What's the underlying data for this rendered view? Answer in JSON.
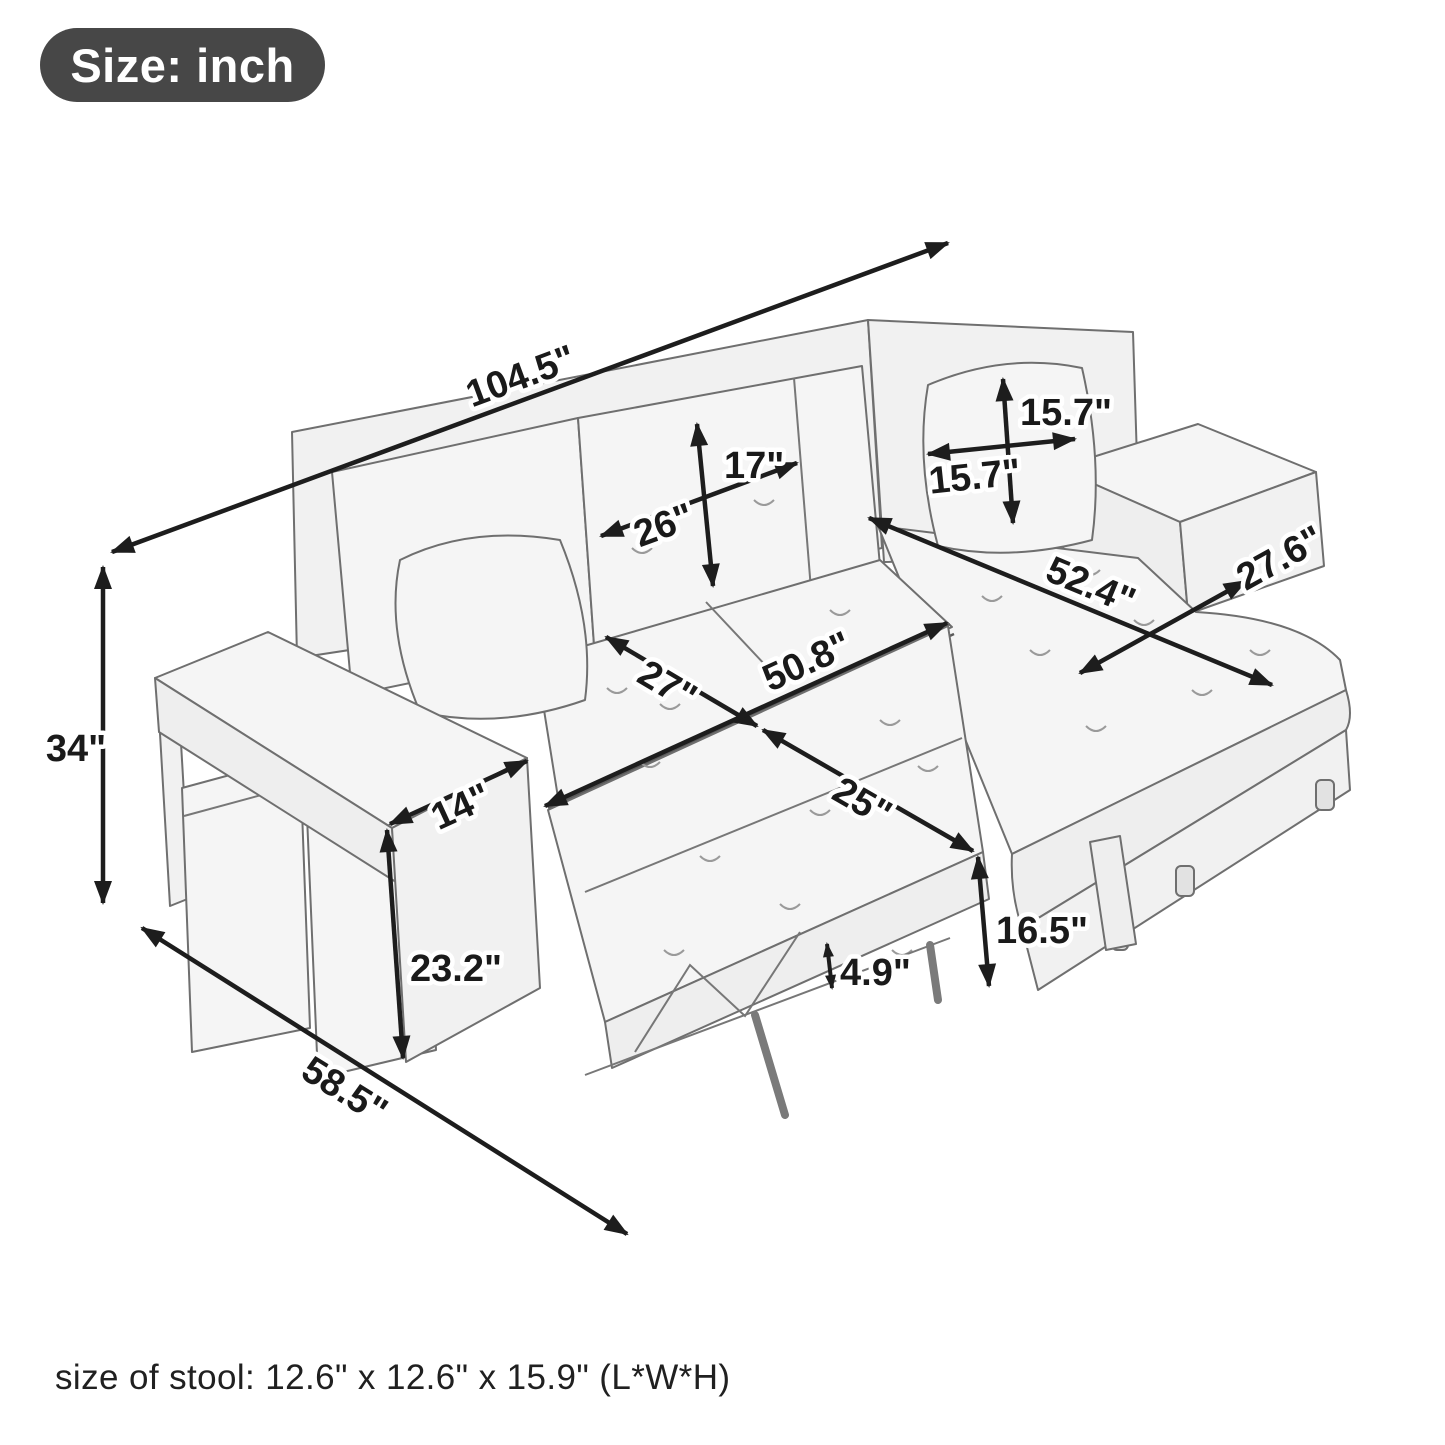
{
  "badge": {
    "label": "Size: inch"
  },
  "footer": {
    "stool_note": "size of stool: 12.6\" x 12.6\" x 15.9\" (L*W*H)"
  },
  "dims": {
    "overall_length": "104.5\"",
    "overall_height": "34\"",
    "overall_depth": "58.5\"",
    "back_cushion_height": "17\"",
    "back_cushion_width": "26\"",
    "pillow_height": "15.7\"",
    "pillow_width": "15.7\"",
    "chaise_length": "52.4\"",
    "chaise_width": "27.6\"",
    "seat_depth": "27\"",
    "bed_length": "50.8\"",
    "bed_depth": "25\"",
    "bed_height": "16.5\"",
    "mattress_thickness": "4.9\"",
    "armrest_height": "23.2\"",
    "armrest_width": "14\""
  },
  "colors": {
    "badge_background": "#474747",
    "dimension_line": "#1d1d1d",
    "sketch_line": "#6f6f6f"
  }
}
